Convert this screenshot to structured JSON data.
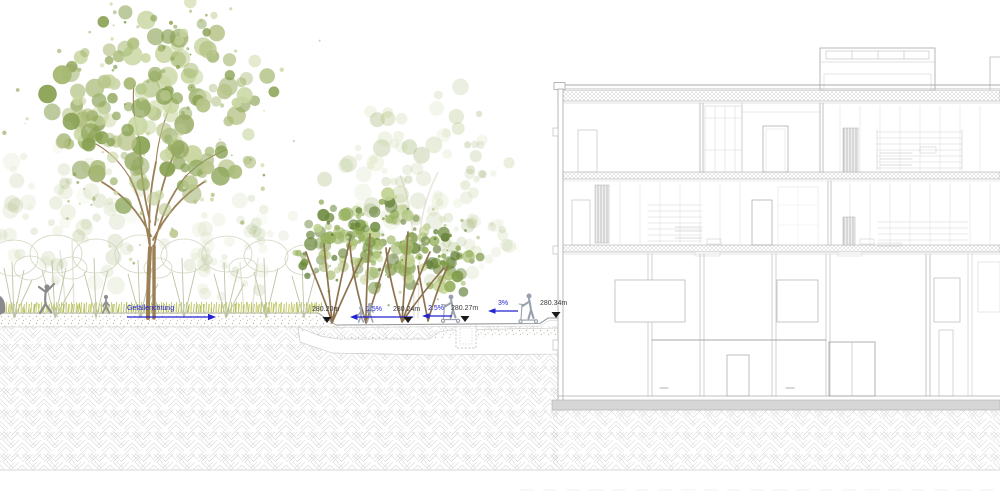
{
  "annotations": {
    "slope_direction_label": "Gefällerichtung",
    "level_markers": [
      {
        "label": "280.20m"
      },
      {
        "label": "280.24m"
      },
      {
        "label": "280.27m"
      },
      {
        "label": "280.34m"
      }
    ],
    "slope_labels": [
      {
        "label": "1.5%"
      },
      {
        "label": "2.5%"
      },
      {
        "label": "3%"
      }
    ]
  },
  "colors": {
    "annotation_blue": "#2323d1",
    "marker_black": "#1a1a1a",
    "label_gray": "#3a3a3a",
    "building_line": "#b5b5b5",
    "earth_hatch": "#d4d4d4",
    "trunk_brown": "#8d734e",
    "grass_green_light": "#c9cf6f",
    "grass_green_dark": "#b2bd59",
    "figure_gray": "#8a8a8a",
    "figure_blue_gray": "#99a1ae",
    "tree_palette": [
      "#b7c489",
      "#a5b871",
      "#93a85e",
      "#c9d7a2",
      "#87a050"
    ],
    "mid_tree_palette": [
      "#7e9a48",
      "#97b25f",
      "#6d8a3e",
      "#a9bf72",
      "#c2d393",
      "#5f7c35"
    ]
  }
}
